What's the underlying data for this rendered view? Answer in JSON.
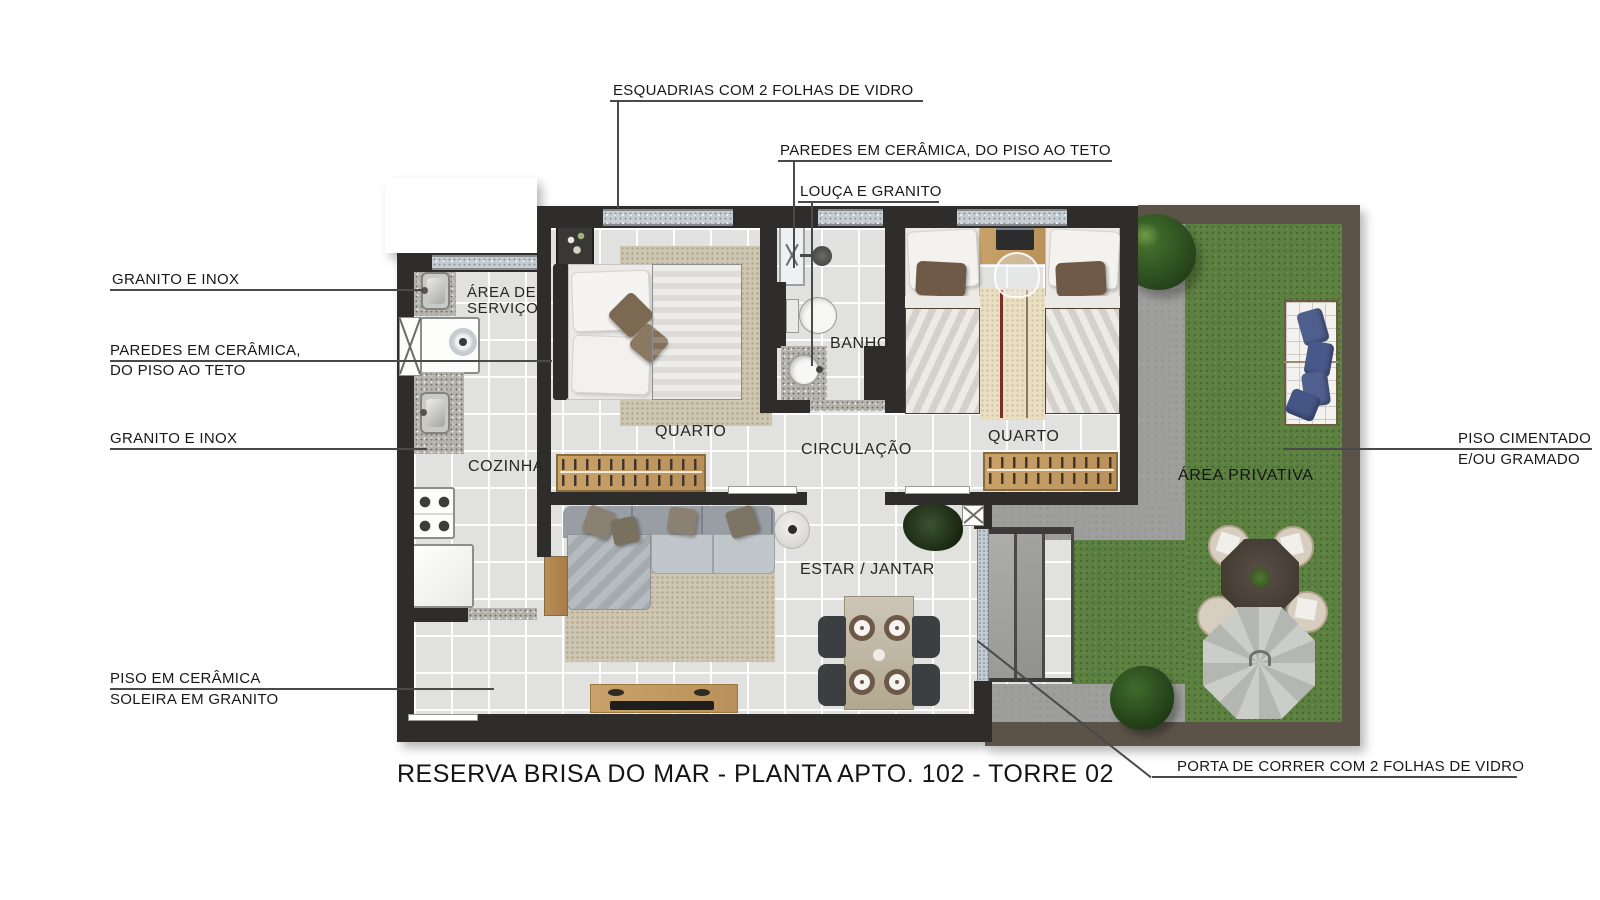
{
  "title": "RESERVA BRISA DO MAR - PLANTA APTO. 102 - TORRE 02",
  "annotations": {
    "esquadrias": "ESQUADRIAS COM 2 FOLHAS DE VIDRO",
    "paredes_top": "PAREDES EM CERÂMICA, DO PISO AO TETO",
    "louca": "LOUÇA E GRANITO",
    "granito_inox_top": "GRANITO E INOX",
    "paredes_left_l1": "PAREDES EM CERÂMICA,",
    "paredes_left_l2": "DO PISO AO TETO",
    "granito_inox_bottom": "GRANITO E INOX",
    "piso_ceramica_l1": "PISO EM CERÂMICA",
    "piso_ceramica_l2": "SOLEIRA EM GRANITO",
    "piso_cimentado_l1": "PISO CIMENTADO",
    "piso_cimentado_l2": "E/OU GRAMADO",
    "porta_correr": "PORTA DE CORRER COM 2 FOLHAS DE VIDRO"
  },
  "rooms": {
    "area_servico_l1": "ÁREA DE",
    "area_servico_l2": "SERVIÇO",
    "cozinha": "COZINHA",
    "quarto1": "QUARTO",
    "banho": "BANHO",
    "circulacao": "CIRCULAÇÃO",
    "quarto2": "QUARTO",
    "estar_jantar": "ESTAR / JANTAR",
    "area_privativa": "ÁREA PRIVATIVA"
  },
  "colors": {
    "wall": "#2e2d2b",
    "outdoor_wall": "#5b5348",
    "floor_tile": "#e1e1df",
    "granite": "#b5b3ac",
    "wood": "#c49e66",
    "grass": "#5d8141",
    "concrete": "#9e9e9c",
    "rug": "#cfc6b1",
    "pillow_blue": "#4f5f8d",
    "leader_line": "#4a4a4a"
  }
}
